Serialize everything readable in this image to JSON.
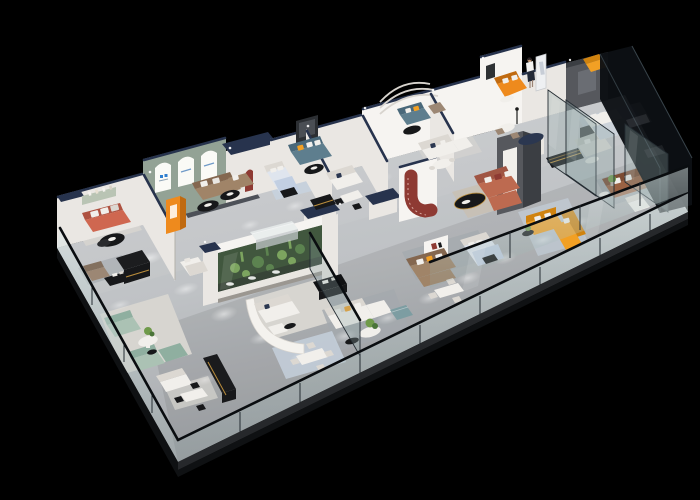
{
  "scene": {
    "title": "3D isometric cutaway render of a furniture showroom floor plan on a black background",
    "background": "#000000"
  },
  "palette": {
    "bg": "#000000",
    "floor_a": "#c9cbce",
    "floor_b": "#a6a9ad",
    "slab": "#26282b",
    "slab_dark": "#0f1113",
    "wall": "#eae7e3",
    "wall_bright": "#f6f4f1",
    "wall_shade": "#cfccc6",
    "wall_side": "#b3b0aa",
    "cap": "#27334d",
    "arch_wall": "#93a295",
    "arch_white": "#fafaf6",
    "logo_blue": "#2f7fd0",
    "deco": "#d8d4ce",
    "feat_gray": "#56585d",
    "feat_gray_dk": "#3b3e43",
    "feat_red": "#8e3a33",
    "glass": "#8ea6a4",
    "glass_dark": "#0c1014",
    "frame": "#242c32",
    "rail": "#0a0d10",
    "orange": "#ee8a1d",
    "orange_dk": "#c06a10",
    "amber": "#f2a024",
    "amber_dk": "#d0830f",
    "coral": "#cf6750",
    "coral_dk": "#ae5140",
    "taupe": "#9c8774",
    "taupe_dk": "#83705f",
    "brown": "#a08468",
    "brown_dk": "#84674f",
    "caramel": "#9a6243",
    "caramel_dk": "#7c4c33",
    "teal": "#5e7e8e",
    "teal_dk": "#49687a",
    "sage": "#abc2b4",
    "sage_dk": "#8fafa0",
    "slate": "#7d9da2",
    "white": "#f1efeb",
    "white_dk": "#dcd8d2",
    "cream": "#e9e6e1",
    "navy": "#2b3750",
    "black": "#17181a",
    "gold": "#bb8e3c",
    "green": "#4a7438",
    "green_lt": "#6f9a4a",
    "green_dk": "#2b4023",
    "bed_blue": "#c2cfe2",
    "bed_blue_lt": "#dfe5ee",
    "rug_dark": "#4d5158",
    "rug_light": "#d7d5d0",
    "rug_gray": "#a4a9ae",
    "rug_blue": "#c7d2de",
    "rug_beige": "#c8c0b4",
    "glow": "#ffffff"
  }
}
